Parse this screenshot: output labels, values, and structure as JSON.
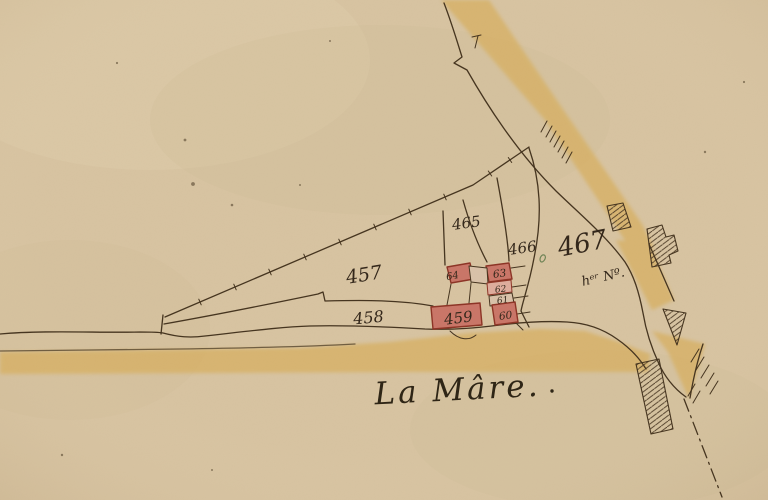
{
  "map": {
    "description": "Old cadastral map sheet (hand-drawn, watercolor on aged paper)",
    "place_name": "La Mâre.",
    "parcel_labels": {
      "p457": "457",
      "p458": "458",
      "p459": "459",
      "p465": "465",
      "p466": "466",
      "p467": "467",
      "p467_note": "hᵉʳ Nº."
    },
    "building_labels": {
      "b60": "60",
      "b61": "61",
      "b62": "62",
      "b63": "63",
      "b64": "64"
    }
  },
  "colors": {
    "paper": "#d8c4a2",
    "paper_light": "#e0cfae",
    "paper_dark": "#c9b28d",
    "road_yellow": "#d8b267",
    "ink": "#45341f",
    "label_ink": "#32261a",
    "building_fill": "#ca7668",
    "building_stroke": "#8d3426",
    "building_light": "#dfad9d",
    "yard_fill": "#d9c2a9",
    "green_mark": "#6f8456",
    "place_ink": "#2d2415"
  }
}
